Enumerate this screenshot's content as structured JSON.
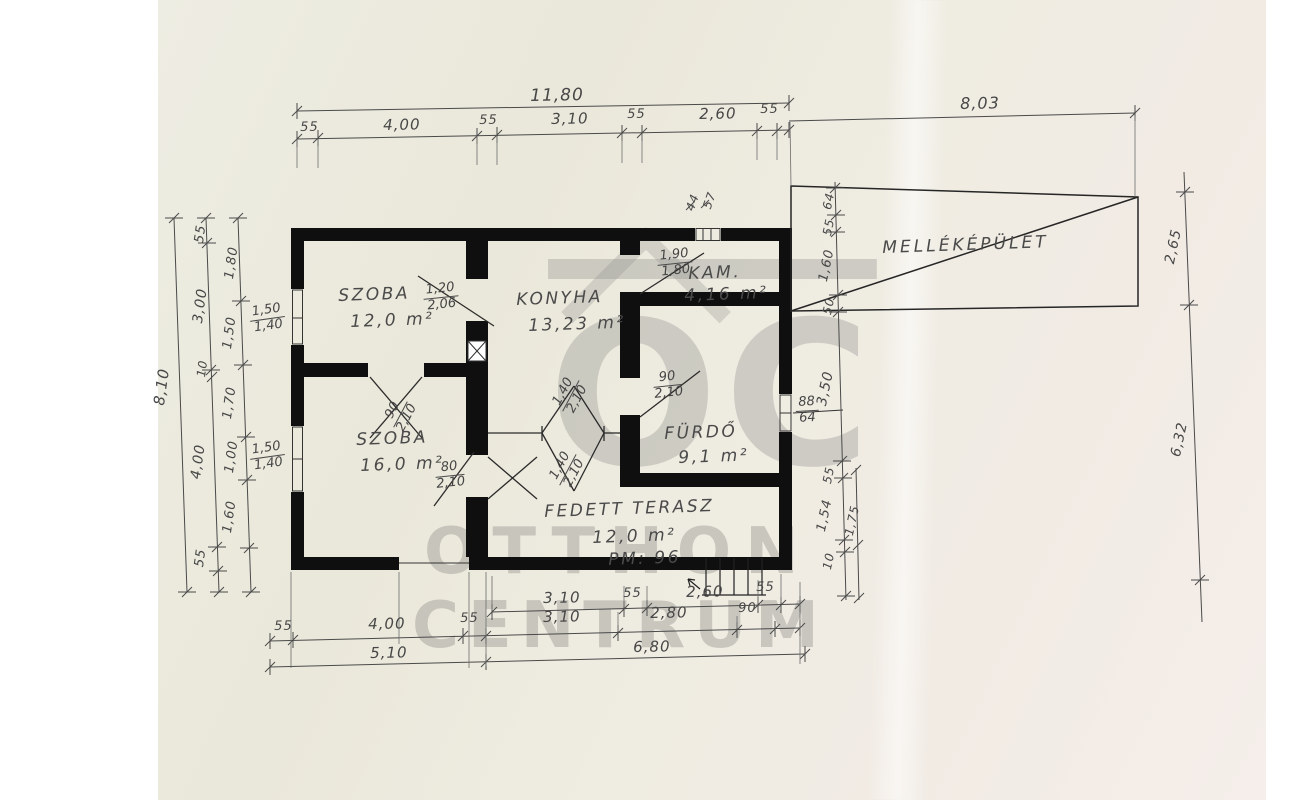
{
  "watermark": {
    "logo": "OC",
    "line1": "OTTHON",
    "line2": "CENTRUM"
  },
  "rooms": {
    "szoba1": {
      "name": "SZOBA",
      "area": "12,0 m²"
    },
    "konyha": {
      "name": "KONYHA",
      "area": "13,23 m²"
    },
    "kamra": {
      "name": "KAM.",
      "area": "4,16 m²"
    },
    "szoba2": {
      "name": "SZOBA",
      "area": "16,0 m²"
    },
    "furdo": {
      "name": "FÜRDŐ",
      "area": "9,1 m²"
    },
    "terasz": {
      "name": "FEDETT TERASZ",
      "area": "12,0 m²",
      "note": "PM: 96"
    },
    "mellekepulet": {
      "name": "MELLÉKÉPÜLET"
    }
  },
  "dims": {
    "top_total": "11,80",
    "top_segments": [
      "55",
      "4,00",
      "55",
      "3,10",
      "55",
      "2,60",
      "55"
    ],
    "top_right": "8,03",
    "left_total": "8,10",
    "left_mid": [
      "55",
      "3,00",
      "10",
      "4,00",
      "55"
    ],
    "left_inner": [
      "1,80",
      "1,50",
      "1,70",
      "1,00",
      "1,60"
    ],
    "right_chain": [
      "64",
      "55",
      "1,60",
      "50",
      "3,50",
      "55",
      "1,54",
      "10"
    ],
    "right_offset": "1,75",
    "far_right": [
      "2,65",
      "6,32"
    ],
    "bottom_row1": [
      "3,10",
      "55",
      "2,60",
      "55"
    ],
    "bottom_row2": [
      "55",
      "4,00",
      "55",
      "3,10",
      "2,80",
      "90"
    ],
    "bottom_row3": [
      "5,10",
      "6,80"
    ],
    "vent": [
      "44",
      "57"
    ]
  },
  "openings": {
    "window_left_top": {
      "w": "1,50",
      "h": "1,40"
    },
    "window_left_bottom": {
      "w": "1,50",
      "h": "1,40"
    },
    "door_szoba1": {
      "w": "1,20",
      "h": "2,06"
    },
    "door_rooms": {
      "w": "90",
      "h": "2,10"
    },
    "door_kamra": {
      "w": "1,90",
      "h": "1,80"
    },
    "door_furdo": {
      "w": "90",
      "h": "2,10"
    },
    "door_szoba2": {
      "w": "80",
      "h": "2,10"
    },
    "door_konyha_a": {
      "w": "1,40",
      "h": "2,10"
    },
    "door_konyha_b": {
      "w": "1,40",
      "h": "2,10"
    },
    "window_furdo": {
      "w": "88",
      "h": "64"
    }
  }
}
